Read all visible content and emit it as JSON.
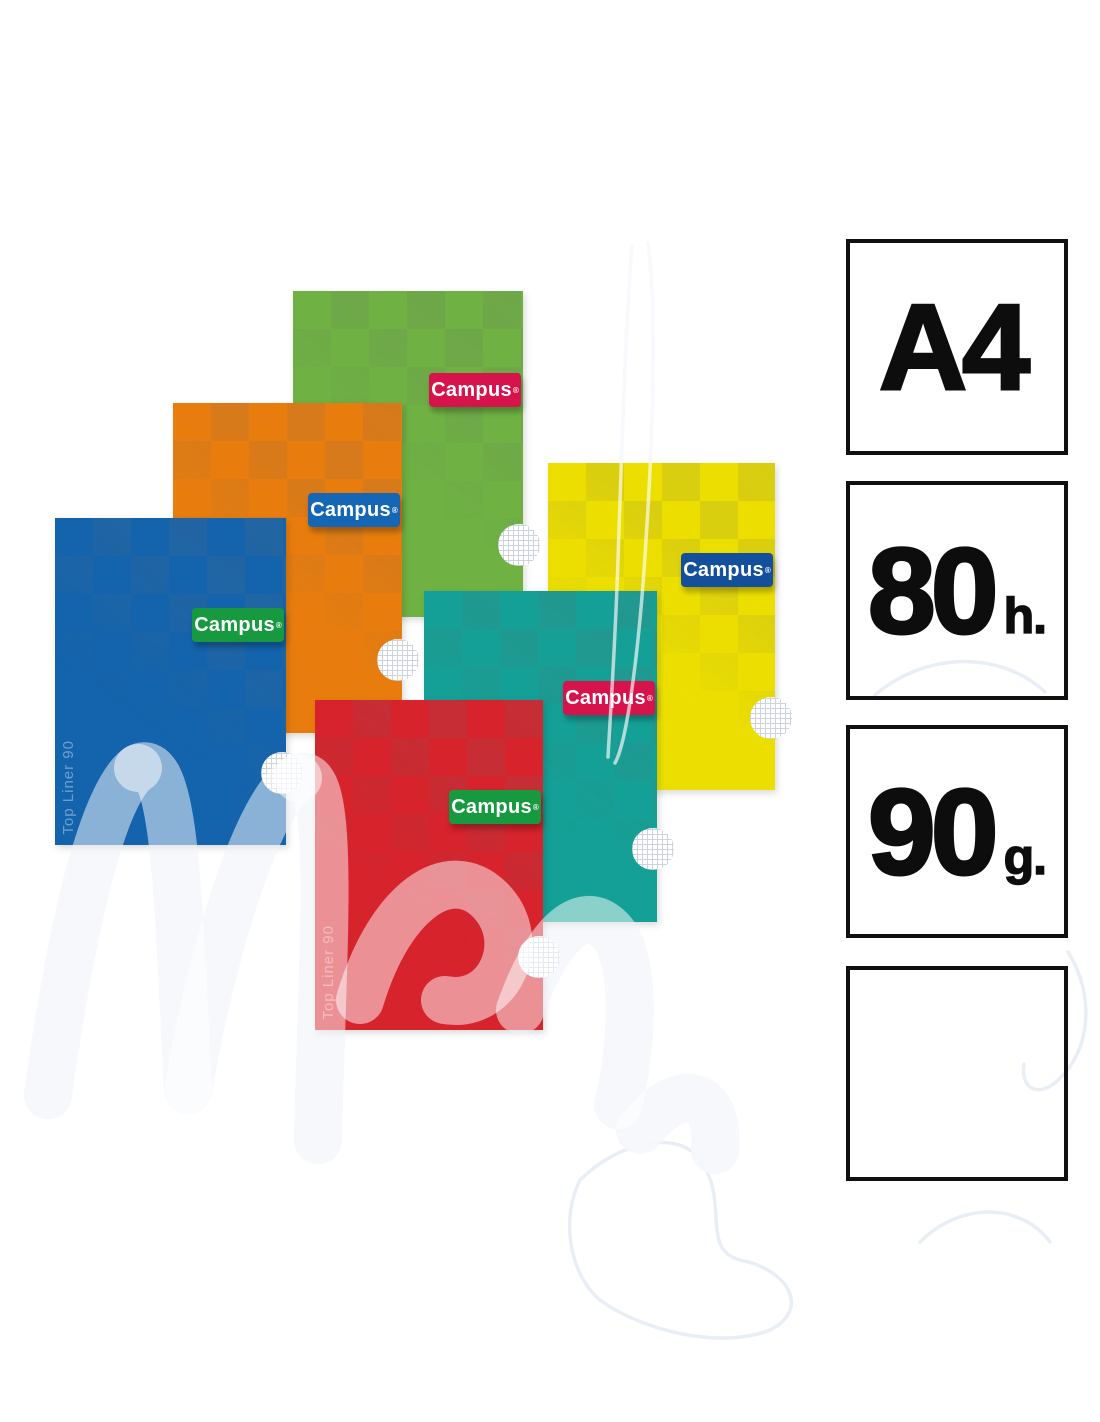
{
  "watermark": {
    "script_text": "Mena"
  },
  "product": {
    "brand": "Campus",
    "reg_mark": "®",
    "notebooks": [
      {
        "name": "green",
        "cover_color": "#6fb243",
        "label_color": "#d6134a",
        "brand": "Campus",
        "spine_text": "Top Liner 90"
      },
      {
        "name": "orange",
        "cover_color": "#e87d0e",
        "label_color": "#1566b4",
        "brand": "Campus",
        "spine_text": "Top Liner 90"
      },
      {
        "name": "blue",
        "cover_color": "#1464ad",
        "label_color": "#17993f",
        "brand": "Campus",
        "spine_text": "Top Liner 90"
      },
      {
        "name": "yellow",
        "cover_color": "#ecdf00",
        "label_color": "#144f9c",
        "brand": "Campus",
        "spine_text": "Top Liner 90"
      },
      {
        "name": "teal",
        "cover_color": "#14a096",
        "label_color": "#d6134a",
        "brand": "Campus",
        "spine_text": "Top Liner 90"
      },
      {
        "name": "red",
        "cover_color": "#d6232c",
        "label_color": "#17993f",
        "brand": "Campus",
        "spine_text": "Top Liner 90"
      }
    ]
  },
  "specs": [
    {
      "value": "A4",
      "unit": ""
    },
    {
      "value": "80",
      "unit": "h."
    },
    {
      "value": "90",
      "unit": "g."
    },
    {
      "value": "",
      "unit": ""
    }
  ]
}
